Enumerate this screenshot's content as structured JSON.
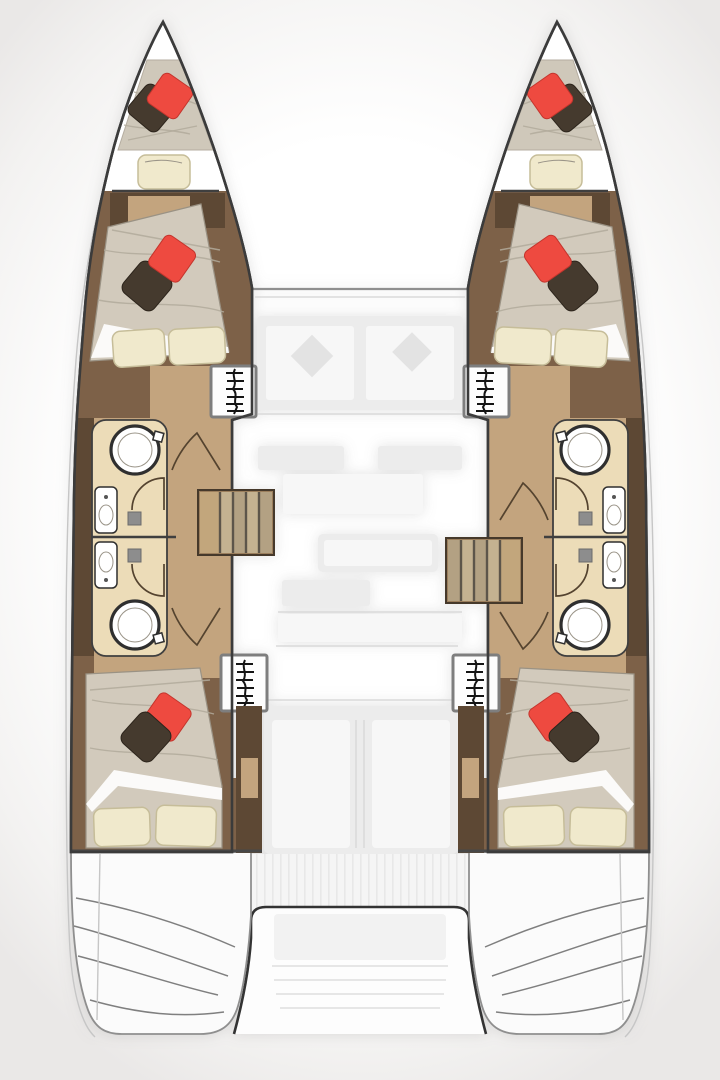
{
  "title": "Catamaran interior layout floor plan, top-down view: two hulls with four guest cabins, two bow berths, four bathrooms, and ghosted saloon, cockpit and aft platform between the hulls",
  "vessel": {
    "type": "catamaran",
    "hull_count": 2,
    "cabin_count": 4,
    "bow_berth_count": 2,
    "bathroom_count": 4
  },
  "floorplan": {
    "port_hull": {
      "rooms": [
        "bow-berth",
        "forward-cabin",
        "forward-bathroom",
        "aft-bathroom",
        "aft-cabin"
      ],
      "features": [
        "forward-companionway-hatch",
        "aft-companionway-hatch",
        "stairs-to-saloon",
        "corridor",
        "cabin-doors",
        "wardrobe"
      ]
    },
    "starboard_hull": {
      "rooms": [
        "bow-berth",
        "forward-cabin",
        "forward-bathroom",
        "aft-bathroom",
        "aft-cabin"
      ],
      "features": [
        "forward-companionway-hatch",
        "aft-companionway-hatch",
        "stairs-to-saloon",
        "corridor",
        "cabin-doors",
        "wardrobe"
      ]
    },
    "bathroom_fixtures_per_room": [
      "round-shower",
      "sink-vanity",
      "toilet-square"
    ],
    "bed_dressing": [
      "beige-duvet",
      "red-accent-pillow",
      "dark-accent-pillow",
      "cream-pillows"
    ],
    "bridgedeck_ghosted": [
      "front-seating",
      "saloon-galley",
      "saloon-table",
      "sofa",
      "cockpit-benches",
      "aft-deck-teak",
      "aft-platform-recess",
      "transom-steps"
    ]
  },
  "colors": {
    "hull_white": "#ffffff",
    "outline_dark": "#3b3b3b",
    "wood_dark": "#5d4834",
    "wood_mid": "#7d6148",
    "wood_light": "#c3a47e",
    "stair_seam": "#5d554a",
    "tile": "#ecdcb8",
    "bed_duvet": "#d2cabc",
    "bed_mattress": "#cfc8ba",
    "bed_wrinkle": "#b2aa9b",
    "pillow_red": "#ee4a40",
    "pillow_red_dark": "#c4352d",
    "pillow_dark": "#453a2e",
    "pillow_cream": "#f0e9cc",
    "pillow_cream_edge": "#c6bd99",
    "fixture_white": "#ffffff",
    "fixture_ring": "#2f2f2f",
    "gray_box": "#8d8d8d",
    "hatch_border": "#7e7e7e",
    "glyph_black": "#141414",
    "ghost_fill": "#ececec",
    "ghost_line": "#dadada"
  }
}
